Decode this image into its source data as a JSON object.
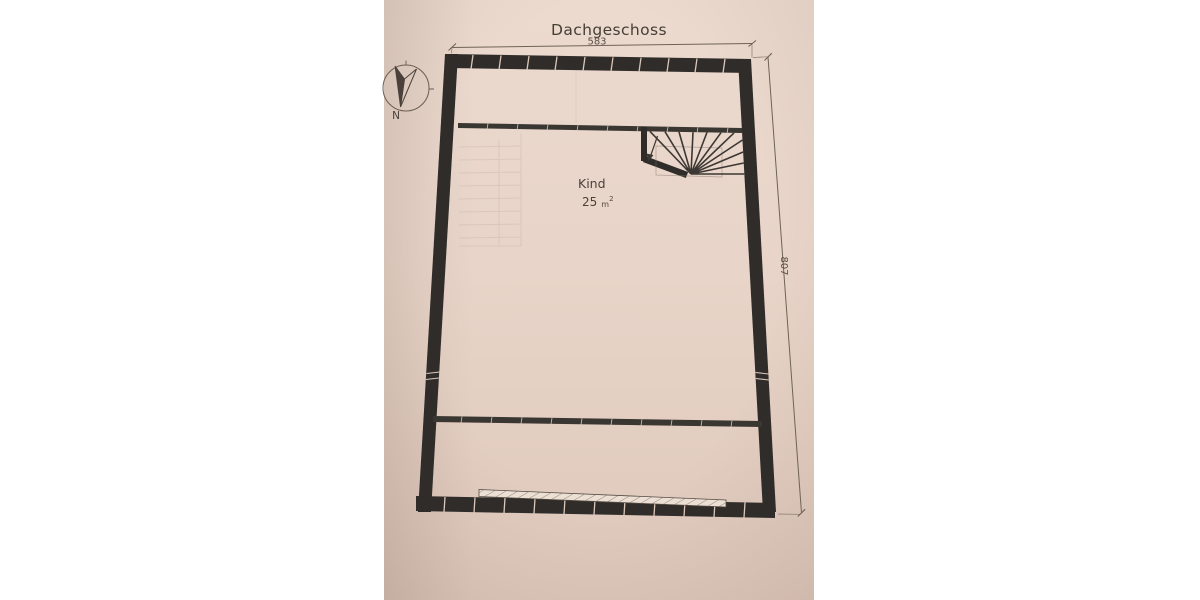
{
  "plan": {
    "title": "Dachgeschoss",
    "room": {
      "name": "Kind",
      "area_value": "25",
      "area_unit": "m",
      "area_exponent": "2"
    },
    "dimensions": {
      "top": "583",
      "right": "807"
    },
    "compass": {
      "north_label": "N"
    },
    "colors": {
      "background": "#ffffff",
      "paper": "#e8d4c8",
      "wall": "#2f2c29",
      "interior_wall": "#3a3631",
      "dimension_line": "#6f6356",
      "text": "#4a423a",
      "hatch_strip": "#ece0d5"
    }
  }
}
